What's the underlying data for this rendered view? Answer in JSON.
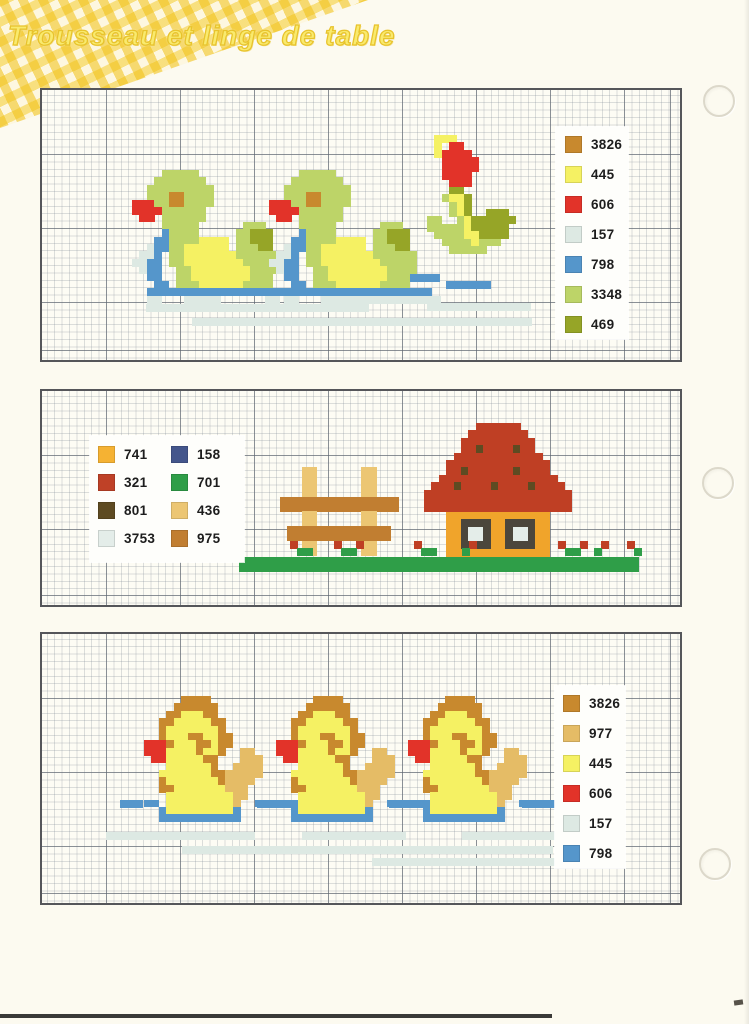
{
  "page": {
    "title": "Trousseau et linge de table"
  },
  "palette": {
    "3826": "#c8892e",
    "977": "#e5bc66",
    "445": "#f5f163",
    "606": "#e23329",
    "157": "#dde9e3",
    "798": "#5596cb",
    "3348": "#bdd468",
    "469": "#96a527",
    "741": "#f0a42b",
    "158": "#44568c",
    "321": "#bf3f24",
    "701": "#2f9e48",
    "801": "#5e4b22",
    "436": "#ecc673",
    "3753": "#e4ede9",
    "975": "#c17e31",
    "window_frame": "#4b463c",
    "legend_741": "#f5b233",
    "legend_321": "#bf4127"
  },
  "cell": 7.4,
  "charts": [
    {
      "name": "green-ducks-border",
      "frame": {
        "x": 40,
        "y": 88,
        "w": 642,
        "h": 274
      },
      "legend": {
        "x": 514,
        "y": 37,
        "w": 72,
        "h": 212,
        "cols": 1,
        "gap": 13,
        "pad": "9px 0 0 9px",
        "codes": [
          "3826",
          "445",
          "606",
          "157",
          "798",
          "3348",
          "469"
        ]
      },
      "motifs": [
        {
          "name": "duck-green-1",
          "x": 90,
          "y": 80,
          "map": {
            "g": "3348",
            "o": "3826",
            "r": "606",
            "b": "798",
            "y": "445",
            "d": "469",
            "p": "157"
          },
          "rows": [
            "....ggggg...............",
            "...ggggggg..............",
            "..ggggggggg.............",
            "..gggoogggg.............",
            "rrrggoogggg.............",
            "rrrrgggggg..............",
            ".rr.gggggg..............",
            "....ggggg......ggg......",
            "....bgggg.....ggddd.....",
            "...bbggggyyyy.ggddd.....",
            "..pbbggyyyyyy.gggdd.....",
            ".ppb.ggyyyyyyygggggg....",
            "ppbb.ggyyyyyyyyggggg....",
            ".pbb..ggyyyyyyyygggg....",
            "..bb..ggyyyyyyyyggg.....",
            "...bb.gggyyyyyygggg.....",
            "..bbbbbbbbbbbbbbbbbbbb..",
            "..pp...ppppp......pp...."
          ]
        },
        {
          "name": "duck-green-2",
          "x": 227,
          "y": 80,
          "map": {
            "g": "3348",
            "o": "3826",
            "r": "606",
            "b": "798",
            "y": "445",
            "d": "469",
            "p": "157"
          },
          "rows": [
            "....ggggg...............",
            "...ggggggg..............",
            "..ggggggggg.............",
            "..gggoogggg.............",
            "rrrggoogggg.............",
            "rrrrgggggg..............",
            ".rr.gggggg..............",
            "....ggggg......ggg......",
            "....bgggg.....ggddd.....",
            "...bbggggyyyy.ggddd.....",
            "..pbbggyyyyyy.gggdd.....",
            ".ppb.ggyyyyyyygggggg....",
            "ppbb.ggyyyyyyyyggggg....",
            ".pbb..ggyyyyyyyygggg....",
            "..bb..ggyyyyyyyyggg.....",
            "...bb.gggyyyyyygggg.....",
            "..bbbbbbbbbbbbbbbbbbbb..",
            "..pp...ppppp......pp...."
          ]
        },
        {
          "name": "tulip-flower",
          "x": 385,
          "y": 45,
          "map": {
            "y": "445",
            "r": "606",
            "d": "469",
            "g": "3348"
          },
          "rows": [
            ".yyy..........",
            ".y.rr.........",
            ".yrrrr........",
            "..rrrrr.......",
            "..rrrrr.......",
            "..rrrr........",
            "...rrr........",
            "...dd.........",
            "..gyyd........",
            "...gyd........",
            "...gyd..ddd...",
            "gg..gydddddd..",
            "gggggyddddd...",
            ".ggggyydddd...",
            "..ggggyggg....",
            "...ggggg......"
          ]
        }
      ],
      "rects": [
        {
          "name": "water-blue",
          "color": "798",
          "x": 300,
          "y": 191,
          "cols": 5,
          "rows": 1
        },
        {
          "name": "water-blue",
          "color": "798",
          "x": 338,
          "y": 184,
          "cols": 8,
          "rows": 1
        },
        {
          "name": "water-blue",
          "color": "798",
          "x": 404,
          "y": 191,
          "cols": 6,
          "rows": 1
        },
        {
          "name": "water-pale",
          "color": "157",
          "x": 104,
          "y": 214,
          "cols": 30,
          "rows": 1
        },
        {
          "name": "water-pale",
          "color": "157",
          "x": 150,
          "y": 228,
          "cols": 40,
          "rows": 1
        },
        {
          "name": "water-pale",
          "color": "157",
          "x": 310,
          "y": 206,
          "cols": 12,
          "rows": 1
        },
        {
          "name": "water-pale",
          "color": "157",
          "x": 385,
          "y": 213,
          "cols": 14,
          "rows": 1
        },
        {
          "name": "water-pale",
          "color": "157",
          "x": 430,
          "y": 228,
          "cols": 8,
          "rows": 1
        }
      ]
    },
    {
      "name": "house-and-fence-border",
      "frame": {
        "x": 40,
        "y": 389,
        "w": 642,
        "h": 218
      },
      "legend": {
        "x": 48,
        "y": 45,
        "w": 154,
        "h": 126,
        "cols": 2,
        "gap": 11,
        "pad": "10px 0 0 8px",
        "codes": [
          "741",
          "158",
          "321",
          "701",
          "801",
          "436",
          "3753",
          "975"
        ]
      },
      "motifs": [
        {
          "name": "fence",
          "x": 238,
          "y": 76,
          "map": {
            "t": "436",
            "w": "975"
          },
          "rows": [
            "...tt......tt...",
            "...tt......tt...",
            "...tt......tt...",
            "...tt......tt...",
            "wwwwwwwwwwwwwwww",
            "wwwwwwwwwwwwwwww",
            "...tt......tt...",
            "...tt......tt...",
            ".wwwwwwwwwwwwww.",
            ".wwwwwwwwwwwwww.",
            "...tt......tt...",
            "...tt......tt..."
          ]
        },
        {
          "name": "house",
          "x": 382,
          "y": 32,
          "map": {
            "R": "321",
            "e": "801",
            "O": "741",
            "F": "window_frame",
            "P": "3753"
          },
          "rows": [
            ".......RRRRRR.......",
            "......RRRRRRRR......",
            ".....RRRRRRRRRR.....",
            ".....RReRRRReRR.....",
            "....RRRRRRRRRRRR....",
            "...RRRRRRRRRRRRRR...",
            "...RReRRRRRReRRRR...",
            "..RRRRRRRRRRRRRRRR..",
            ".RRReRRRReRRRReRRRR.",
            "RRRRRRRRRRRRRRRRRRRR",
            "RRRRRRRRRRRRRRRRRRRR",
            "RRRRRRRRRRRRRRRRRRRR",
            "...OOOOOOOOOOOOOO...",
            "...OOFFFFOOFFFFOO...",
            "...OOFPPFOOFPPFOO...",
            "...OOFPPFOOFPPFOO...",
            "...OOFFFFOOFFFFOO...",
            "...OOOOOOOOOOOOOO..."
          ]
        },
        {
          "name": "flower-sprig",
          "x": 248,
          "y": 150,
          "map": {
            "R": "321",
            "G": "701"
          },
          "rows": [
            "R..",
            ".GG"
          ]
        },
        {
          "name": "flower-sprig-pair",
          "x": 292,
          "y": 150,
          "map": {
            "R": "321",
            "G": "701"
          },
          "rows": [
            "R..R",
            ".GG."
          ]
        },
        {
          "name": "flower-sprig",
          "x": 372,
          "y": 150,
          "map": {
            "R": "321",
            "G": "701"
          },
          "rows": [
            "R..",
            ".GG"
          ]
        },
        {
          "name": "flower-sprig",
          "x": 420,
          "y": 150,
          "map": {
            "R": "321",
            "G": "701"
          },
          "rows": [
            ".R",
            "G."
          ]
        },
        {
          "name": "flower-sprig-pair",
          "x": 516,
          "y": 150,
          "map": {
            "R": "321",
            "G": "701"
          },
          "rows": [
            "R..R",
            ".GG."
          ]
        },
        {
          "name": "flower-sprig",
          "x": 552,
          "y": 150,
          "map": {
            "R": "321",
            "G": "701"
          },
          "rows": [
            ".R",
            "G."
          ]
        },
        {
          "name": "flower-sprig",
          "x": 585,
          "y": 150,
          "map": {
            "R": "321",
            "G": "701"
          },
          "rows": [
            "R.",
            ".G"
          ]
        }
      ],
      "rects": [
        {
          "name": "grass-band",
          "color": "701",
          "x": 197,
          "y": 166,
          "cols": 54,
          "rows": 2
        }
      ]
    },
    {
      "name": "yellow-ducklings-border",
      "frame": {
        "x": 40,
        "y": 632,
        "w": 642,
        "h": 273
      },
      "legend": {
        "x": 513,
        "y": 52,
        "w": 70,
        "h": 182,
        "cols": 1,
        "gap": 13,
        "pad": "9px 0 0 8px",
        "codes": [
          "3826",
          "977",
          "445",
          "606",
          "157",
          "798"
        ]
      },
      "motifs": [
        {
          "name": "duckling-1",
          "x": 102,
          "y": 62,
          "map": {
            "o": "3826",
            "y": "445",
            "r": "606",
            "t": "977",
            "b": "798"
          },
          "rows": [
            ".....oooo........",
            "....oooooo.......",
            "...ooyyyoo.......",
            "..ooyyyyyoo......",
            "..oyyyyyyyo......",
            "..oyyyooyyoo.....",
            "rrroyyyooyoo.....",
            "rrryyyyoyyo..tt..",
            ".rryyyyyoo...ttt.",
            "...yyyyyyo..tttt.",
            "..yyyyyyyoottttt.",
            "..oyyyyyyyotttt..",
            "..ooyyyyyyyttt...",
            "...yyyyyyyyytt...",
            "bb.yyyyyyyyyt..bb",
            "..byyyyyyyyyb....",
            "..bbbbbbbbbbb...."
          ]
        },
        {
          "name": "duckling-2",
          "x": 234,
          "y": 62,
          "map": {
            "o": "3826",
            "y": "445",
            "r": "606",
            "t": "977",
            "b": "798"
          },
          "rows": [
            ".....oooo........",
            "....oooooo.......",
            "...ooyyyoo.......",
            "..ooyyyyyoo......",
            "..oyyyyyyyo......",
            "..oyyyooyyoo.....",
            "rrroyyyooyoo.....",
            "rrryyyyoyyo..tt..",
            ".rryyyyyoo...ttt.",
            "...yyyyyyo..tttt.",
            "..yyyyyyyoottttt.",
            "..oyyyyyyyotttt..",
            "..ooyyyyyyyttt...",
            "...yyyyyyyyytt...",
            "bb.yyyyyyyyyt..bb",
            "..byyyyyyyyyb....",
            "..bbbbbbbbbbb...."
          ]
        },
        {
          "name": "duckling-3",
          "x": 366,
          "y": 62,
          "map": {
            "o": "3826",
            "y": "445",
            "r": "606",
            "t": "977",
            "b": "798"
          },
          "rows": [
            ".....oooo........",
            "....oooooo.......",
            "...ooyyyoo.......",
            "..ooyyyyyoo......",
            "..oyyyyyyyo......",
            "..oyyyooyyoo.....",
            "rrroyyyooyoo.....",
            "rrryyyyoyyo..tt..",
            ".rryyyyyoo...ttt.",
            "...yyyyyyo..tttt.",
            "..yyyyyyyoottttt.",
            "..oyyyyyyyotttt..",
            "..ooyyyyyyyttt...",
            "...yyyyyyyyytt...",
            "bb.yyyyyyyyyt..bb",
            "..byyyyyyyyyb....",
            "..bbbbbbbbbbb...."
          ]
        }
      ],
      "rects": [
        {
          "name": "water-blue",
          "color": "798",
          "x": 78,
          "y": 166,
          "cols": 3,
          "rows": 1
        },
        {
          "name": "water-blue",
          "color": "798",
          "x": 215,
          "y": 166,
          "cols": 6,
          "rows": 1
        },
        {
          "name": "water-blue",
          "color": "798",
          "x": 347,
          "y": 166,
          "cols": 6,
          "rows": 1
        },
        {
          "name": "water-blue",
          "color": "798",
          "x": 480,
          "y": 166,
          "cols": 5,
          "rows": 1
        },
        {
          "name": "water-pale",
          "color": "157",
          "x": 64,
          "y": 198,
          "cols": 20,
          "rows": 1
        },
        {
          "name": "water-pale",
          "color": "157",
          "x": 140,
          "y": 212,
          "cols": 50,
          "rows": 1
        },
        {
          "name": "water-pale",
          "color": "157",
          "x": 260,
          "y": 198,
          "cols": 14,
          "rows": 1
        },
        {
          "name": "water-pale",
          "color": "157",
          "x": 420,
          "y": 198,
          "cols": 16,
          "rows": 1
        },
        {
          "name": "water-pale",
          "color": "157",
          "x": 330,
          "y": 224,
          "cols": 30,
          "rows": 1
        }
      ]
    }
  ],
  "punch_holes": [
    {
      "x": 703,
      "y": 85
    },
    {
      "x": 702,
      "y": 467
    },
    {
      "x": 699,
      "y": 848
    }
  ]
}
